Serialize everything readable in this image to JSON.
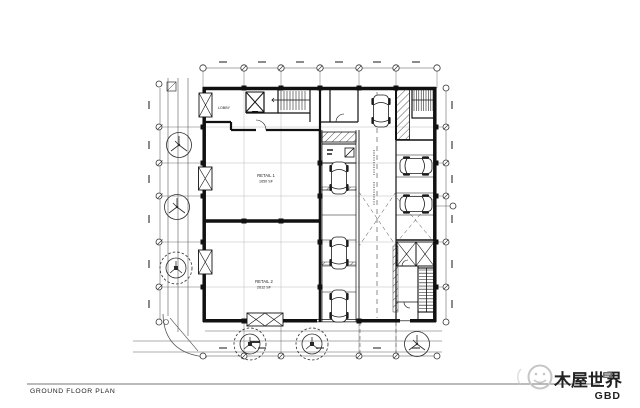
{
  "footer": {
    "title": "GROUND FLOOR PLAN",
    "watermark_text": "木屋世界",
    "brand": "GBD"
  },
  "plan": {
    "lobby_label": "LOBBY",
    "retail1_label": "RETAIL 1",
    "retail1_area": "1650 SF",
    "retail2_label": "RETAIL 2",
    "retail2_area": "2612 SF"
  },
  "colors": {
    "ink": "#1b1b1b",
    "light_line": "#909090",
    "watermark_gray": "#c6c6c6",
    "brand_color": "#222222"
  }
}
